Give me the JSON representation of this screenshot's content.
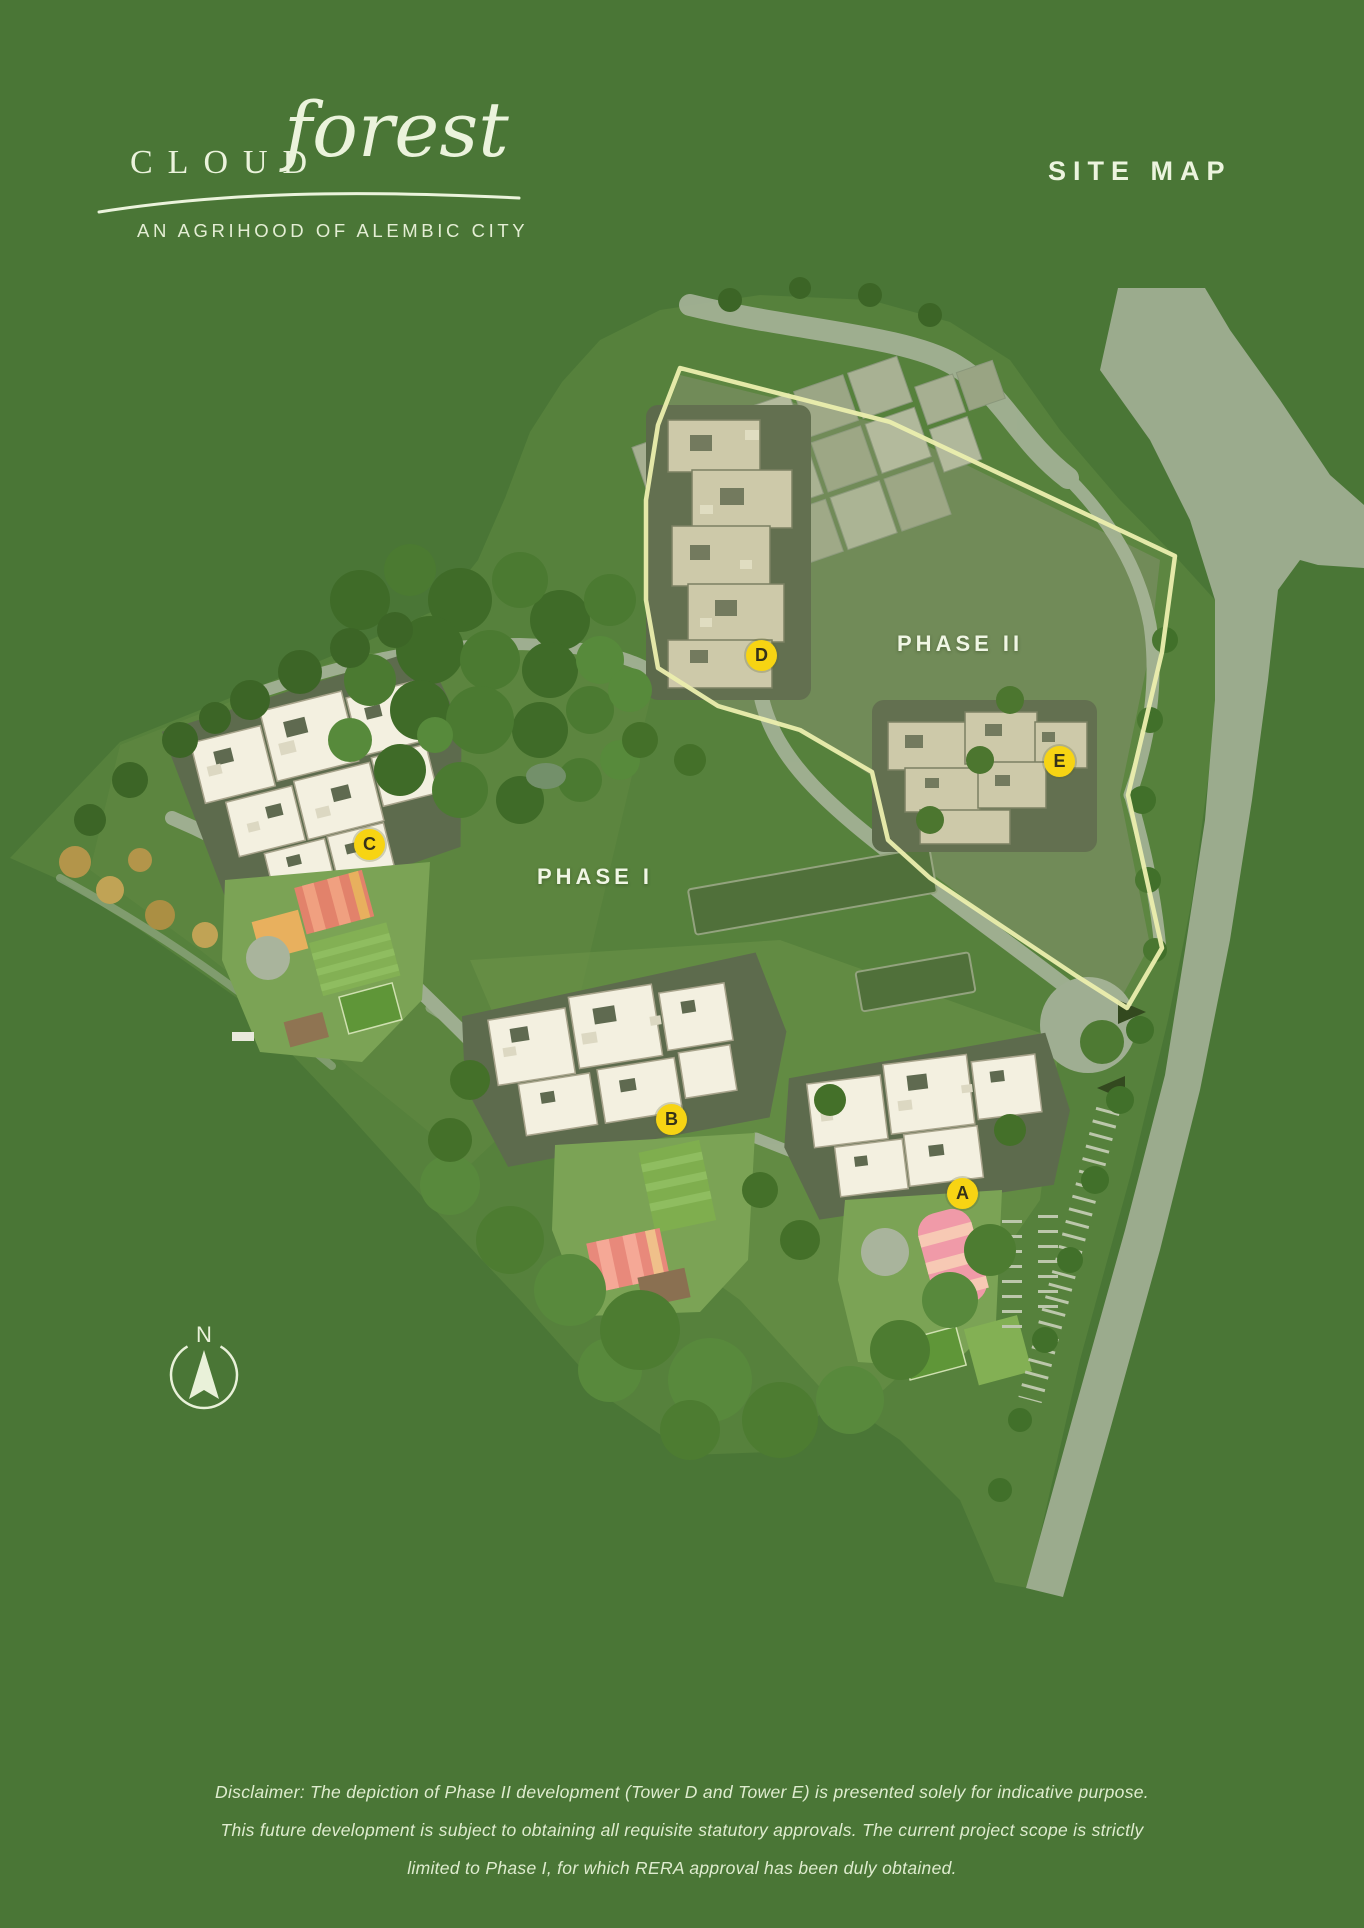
{
  "page": {
    "background_color": "#4a7636"
  },
  "header": {
    "logo": {
      "word_caps": "CLOUD",
      "word_script": "forest",
      "tagline": "AN AGRIHOOD OF ALEMBIC CITY"
    },
    "page_title": "SITE MAP"
  },
  "map": {
    "phase_labels": {
      "phase1": "PHASE I",
      "phase2": "PHASE II"
    },
    "tower_markers": [
      {
        "letter": "A"
      },
      {
        "letter": "B"
      },
      {
        "letter": "C"
      },
      {
        "letter": "D"
      },
      {
        "letter": "E"
      }
    ],
    "marker_color": "#f7d413",
    "phase2_boundary_color": "#ecefae"
  },
  "compass": {
    "label": "N"
  },
  "disclaimer": {
    "line1": "Disclaimer: The depiction of Phase II development (Tower D and Tower E) is presented solely for indicative purpose.",
    "line2": "This future development is subject to obtaining all requisite statutory approvals. The current project scope is strictly",
    "line3": "limited to Phase I, for which RERA approval has been duly obtained."
  }
}
